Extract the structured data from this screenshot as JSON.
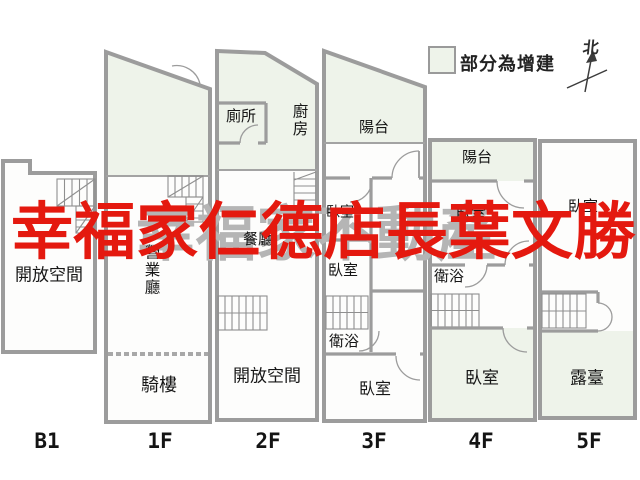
{
  "legend": {
    "addition_label": "部分為增建",
    "north_label": "北"
  },
  "watermarks": {
    "agent": "幸福家仁德店長葉文勝",
    "brand": "幸福家不動產"
  },
  "colors": {
    "addition": "#eef3ea",
    "watermark_red": "#e4190f",
    "watermark_gray": "#b5b5b5",
    "wall": "#9c9c9c"
  },
  "floors": [
    {
      "label": "B1",
      "rooms": [
        {
          "name": "開放空間"
        }
      ]
    },
    {
      "label": "1F",
      "rooms": [
        {
          "name": "營業廳"
        },
        {
          "name": "騎樓"
        }
      ]
    },
    {
      "label": "2F",
      "rooms": [
        {
          "name": "廁所"
        },
        {
          "name": "廚房"
        },
        {
          "name": "餐廳"
        },
        {
          "name": "開放空間"
        }
      ]
    },
    {
      "label": "3F",
      "rooms": [
        {
          "name": "陽台"
        },
        {
          "name": "臥室"
        },
        {
          "name": "臥室"
        },
        {
          "name": "衛浴"
        },
        {
          "name": "臥室"
        }
      ]
    },
    {
      "label": "4F",
      "rooms": [
        {
          "name": "陽台"
        },
        {
          "name": "臥室"
        },
        {
          "name": "衛浴"
        },
        {
          "name": "臥室"
        }
      ]
    },
    {
      "label": "5F",
      "rooms": [
        {
          "name": "臥室"
        },
        {
          "name": "露臺"
        }
      ]
    }
  ]
}
